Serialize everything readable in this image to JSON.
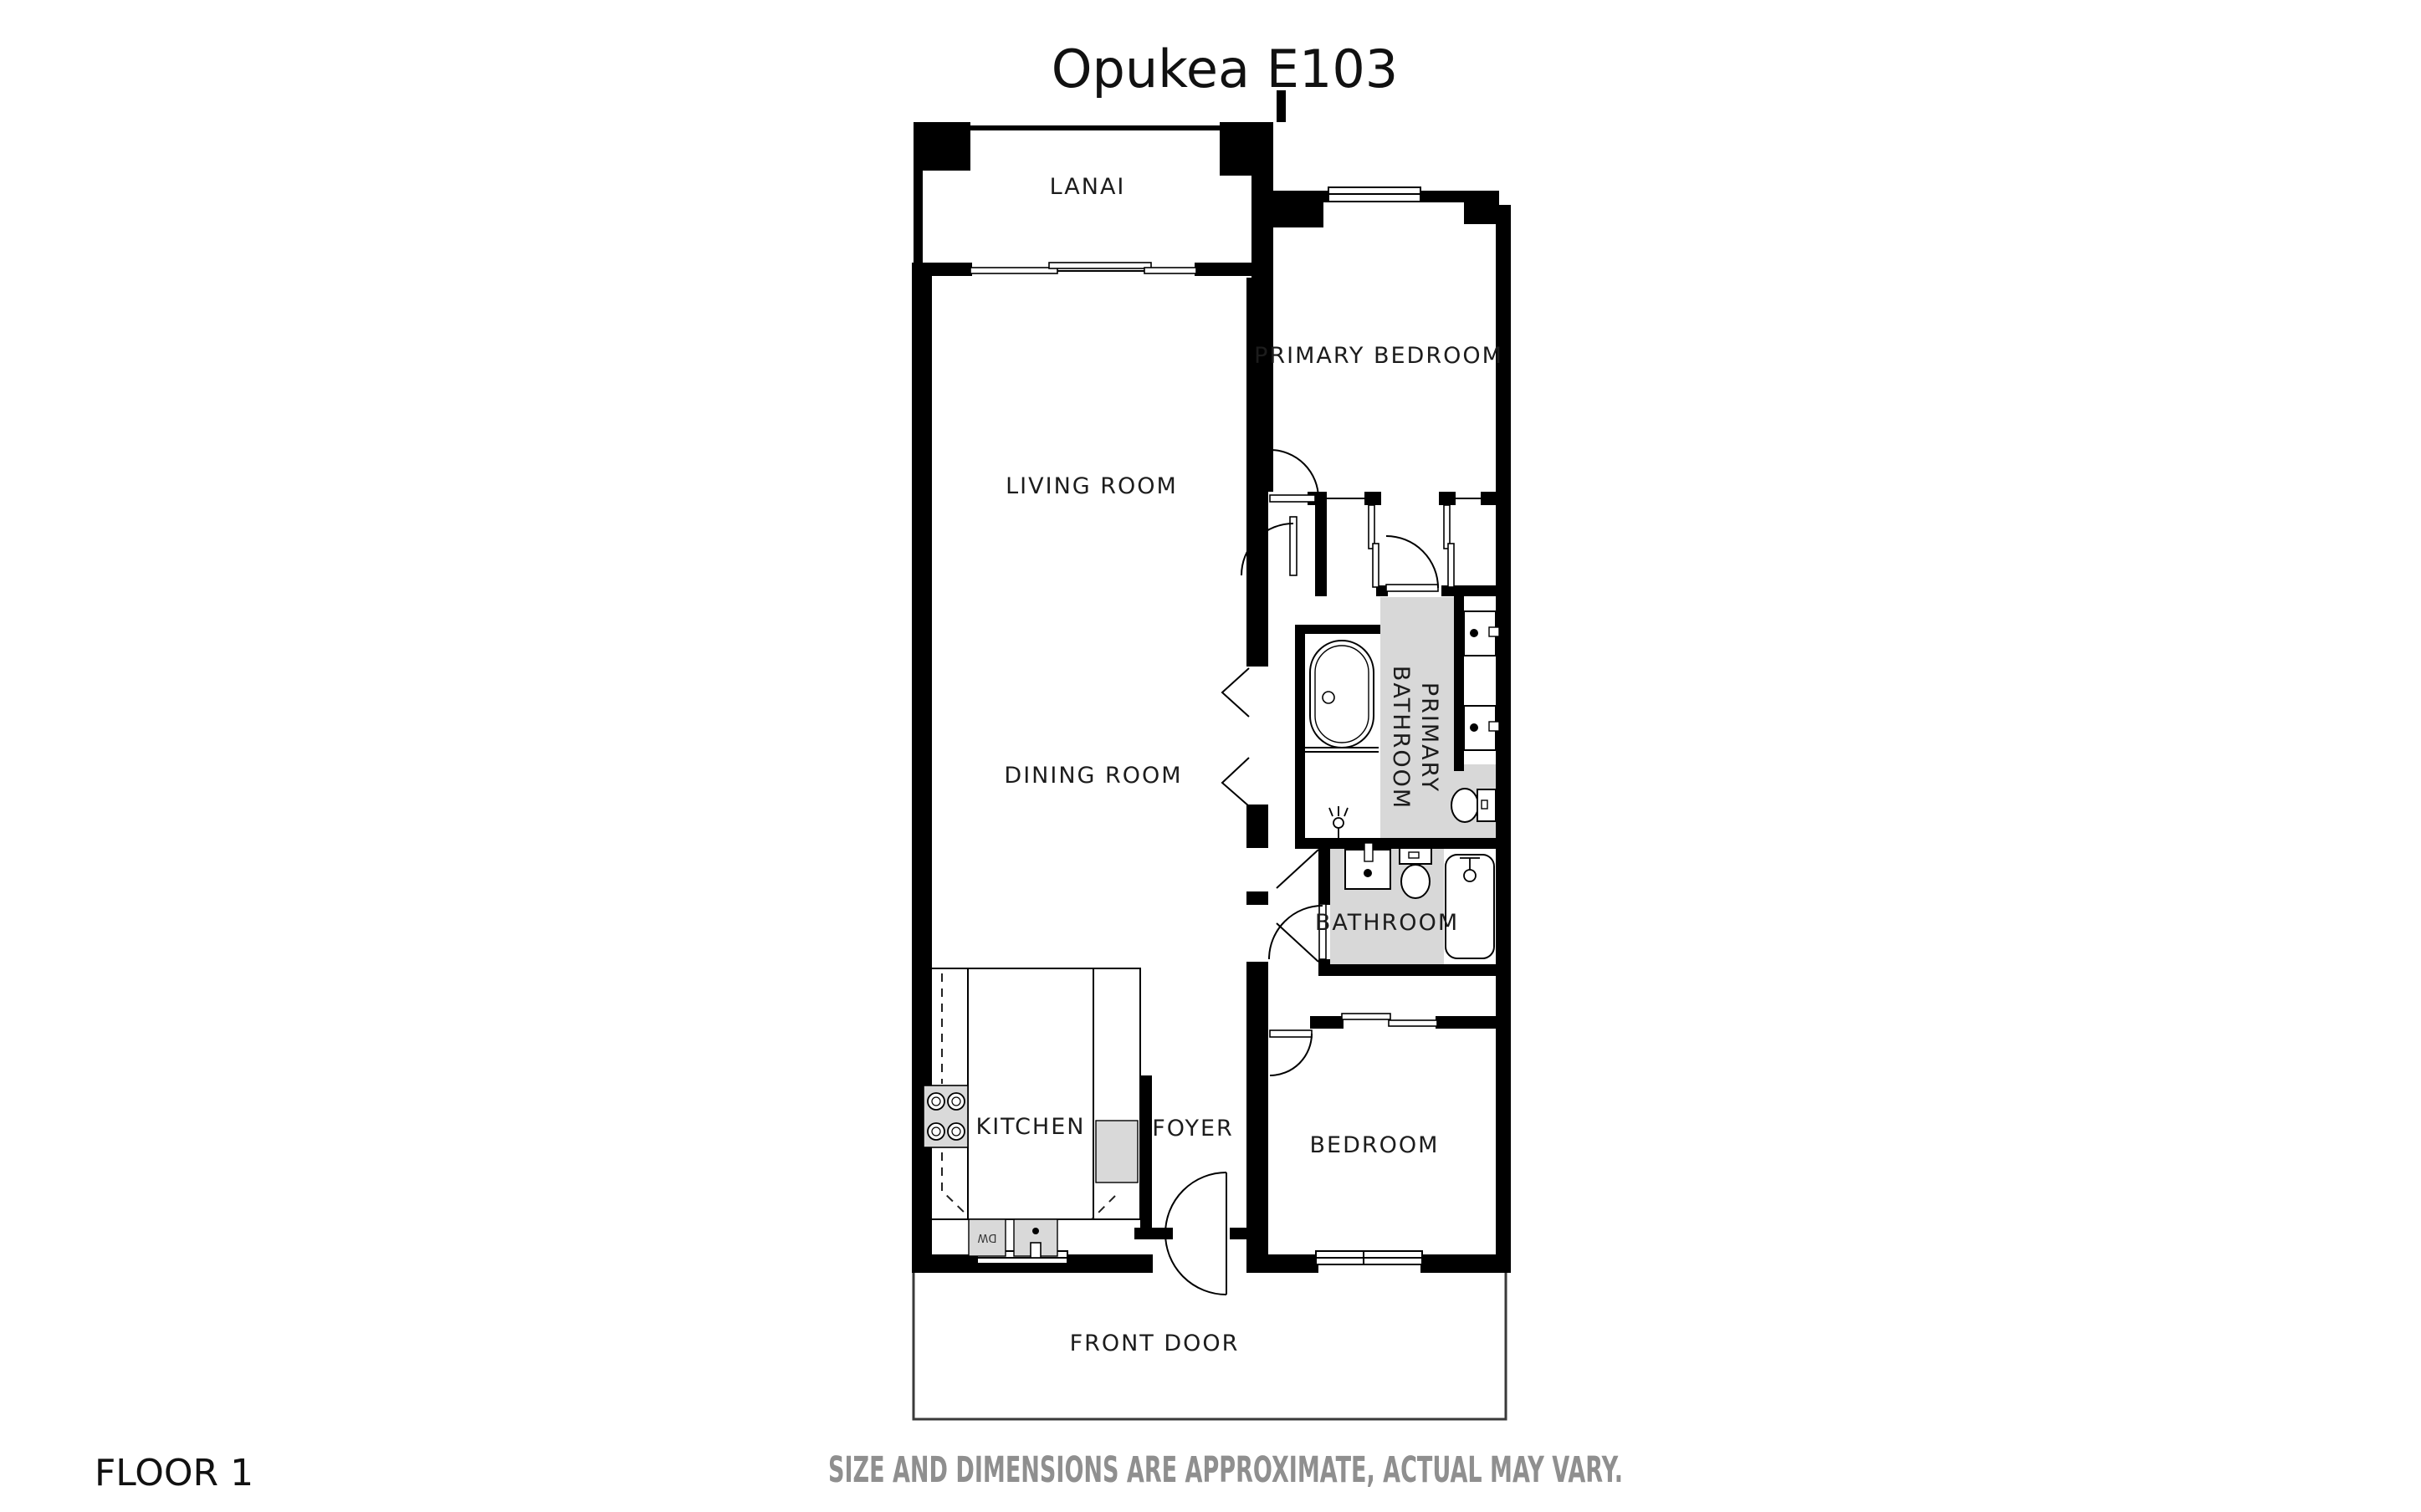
{
  "header": {
    "title": "Opukea E103"
  },
  "footer": {
    "floor_label": "FLOOR 1",
    "disclaimer": "SIZE AND DIMENSIONS ARE APPROXIMATE, ACTUAL MAY VARY."
  },
  "rooms": {
    "lanai": {
      "label": "LANAI"
    },
    "primary_bedroom": {
      "label": "PRIMARY BEDROOM"
    },
    "living_room": {
      "label": "LIVING ROOM"
    },
    "dining_room": {
      "label": "DINING ROOM"
    },
    "primary_bathroom": {
      "label_line1": "PRIMARY",
      "label_line2": "BATHROOM",
      "label_rotation_deg": 90
    },
    "bathroom": {
      "label": "BATHROOM"
    },
    "kitchen": {
      "label": "KITCHEN"
    },
    "foyer": {
      "label": "FOYER"
    },
    "bedroom": {
      "label": "BEDROOM"
    },
    "front_door": {
      "label": "FRONT DOOR"
    }
  },
  "appliances": {
    "dishwasher_label": "DW"
  },
  "fixtures": [
    "lanai-sliding-glass-door",
    "primary-bedroom-window",
    "kitchen-window",
    "bedroom-window",
    "freestanding-bathtub",
    "walk-in-shower-head",
    "double-vanity-sinks",
    "toilet-primary",
    "bathroom-sink",
    "toilet",
    "tub-shower",
    "range-4-burner",
    "dishwasher",
    "kitchen-sink",
    "refrigerator",
    "closet-bypass-sliders",
    "hinged-door-swings",
    "double-swing-front-door"
  ],
  "colors": {
    "walls": "#000000",
    "bathroom_floor": "#d8d8d8",
    "appliance_fill": "#d9d9d9",
    "label_text": "#1c1c1c",
    "disclaimer_text": "#8f8f8f",
    "background": "#ffffff"
  }
}
